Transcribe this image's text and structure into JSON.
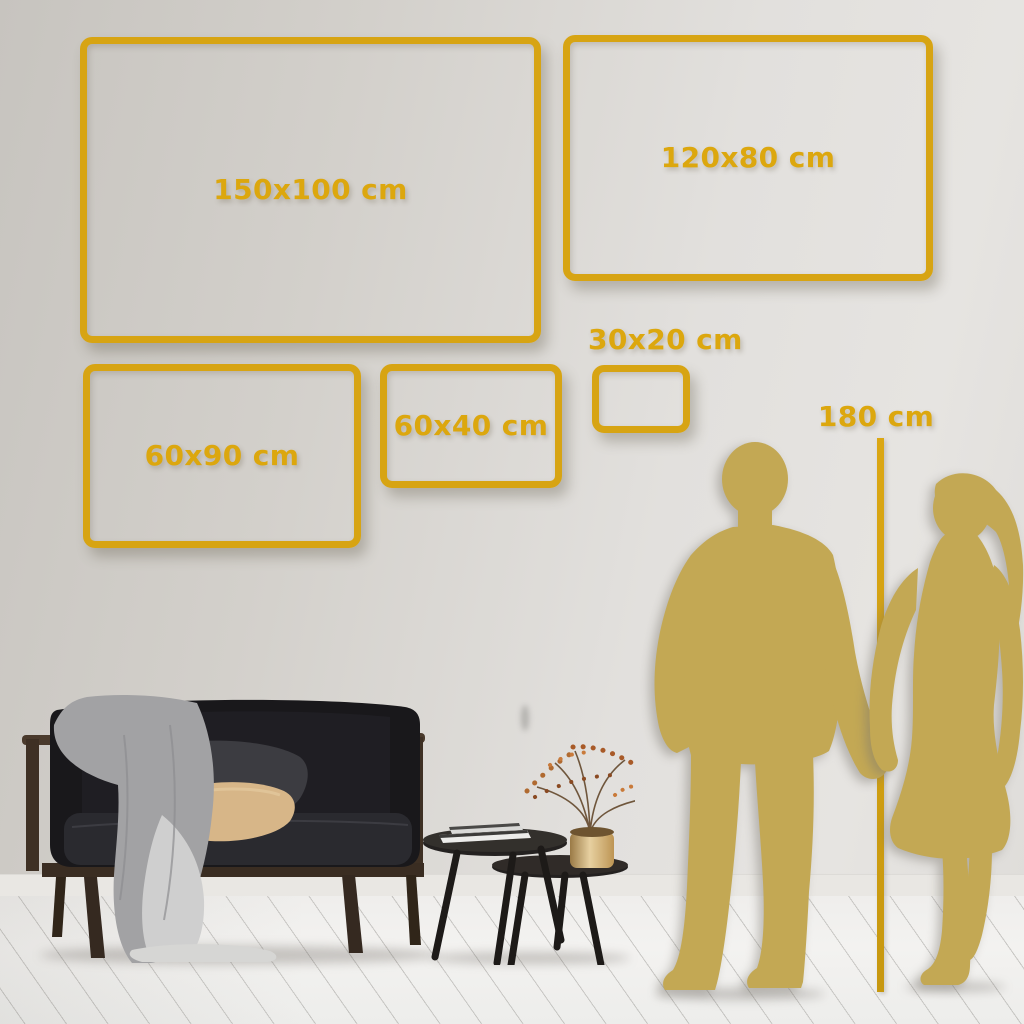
{
  "guide": {
    "unit": "cm",
    "frames": [
      {
        "id": "150x100",
        "label": "150x100 cm",
        "width_cm": 150,
        "height_cm": 100
      },
      {
        "id": "120x80",
        "label": "120x80 cm",
        "width_cm": 120,
        "height_cm": 80
      },
      {
        "id": "60x90",
        "label": "60x90 cm",
        "width_cm": 60,
        "height_cm": 90
      },
      {
        "id": "60x40",
        "label": "60x40 cm",
        "width_cm": 60,
        "height_cm": 40
      },
      {
        "id": "30x20",
        "label": "30x20 cm",
        "width_cm": 30,
        "height_cm": 20
      }
    ],
    "height_reference": {
      "label": "180 cm",
      "height_cm": 180
    }
  },
  "colors": {
    "accent_gold": "#D7A413",
    "label_gold": "#DCA70E",
    "silhouette_gold": "#C3A854",
    "wall_gray_dark": "#C7C4BF",
    "wall_gray_light": "#E6E4E1",
    "floor_white": "#F2F1EF",
    "sofa_charcoal": "#19181B",
    "pillow_beige": "#D7B688"
  },
  "scene_objects": {
    "sofa": "dark velvet loveseat with wood frame",
    "throw_blanket": "gray blanket draped over arm to floor",
    "pillows": "charcoal and beige cushions",
    "tables": "two dark round nesting coffee tables",
    "books": "stacked books on tall table",
    "vase": "brass vase with dried berry branches",
    "silhouettes": "man and woman holding hands",
    "floor": "whitewashed diagonal wood planks"
  }
}
